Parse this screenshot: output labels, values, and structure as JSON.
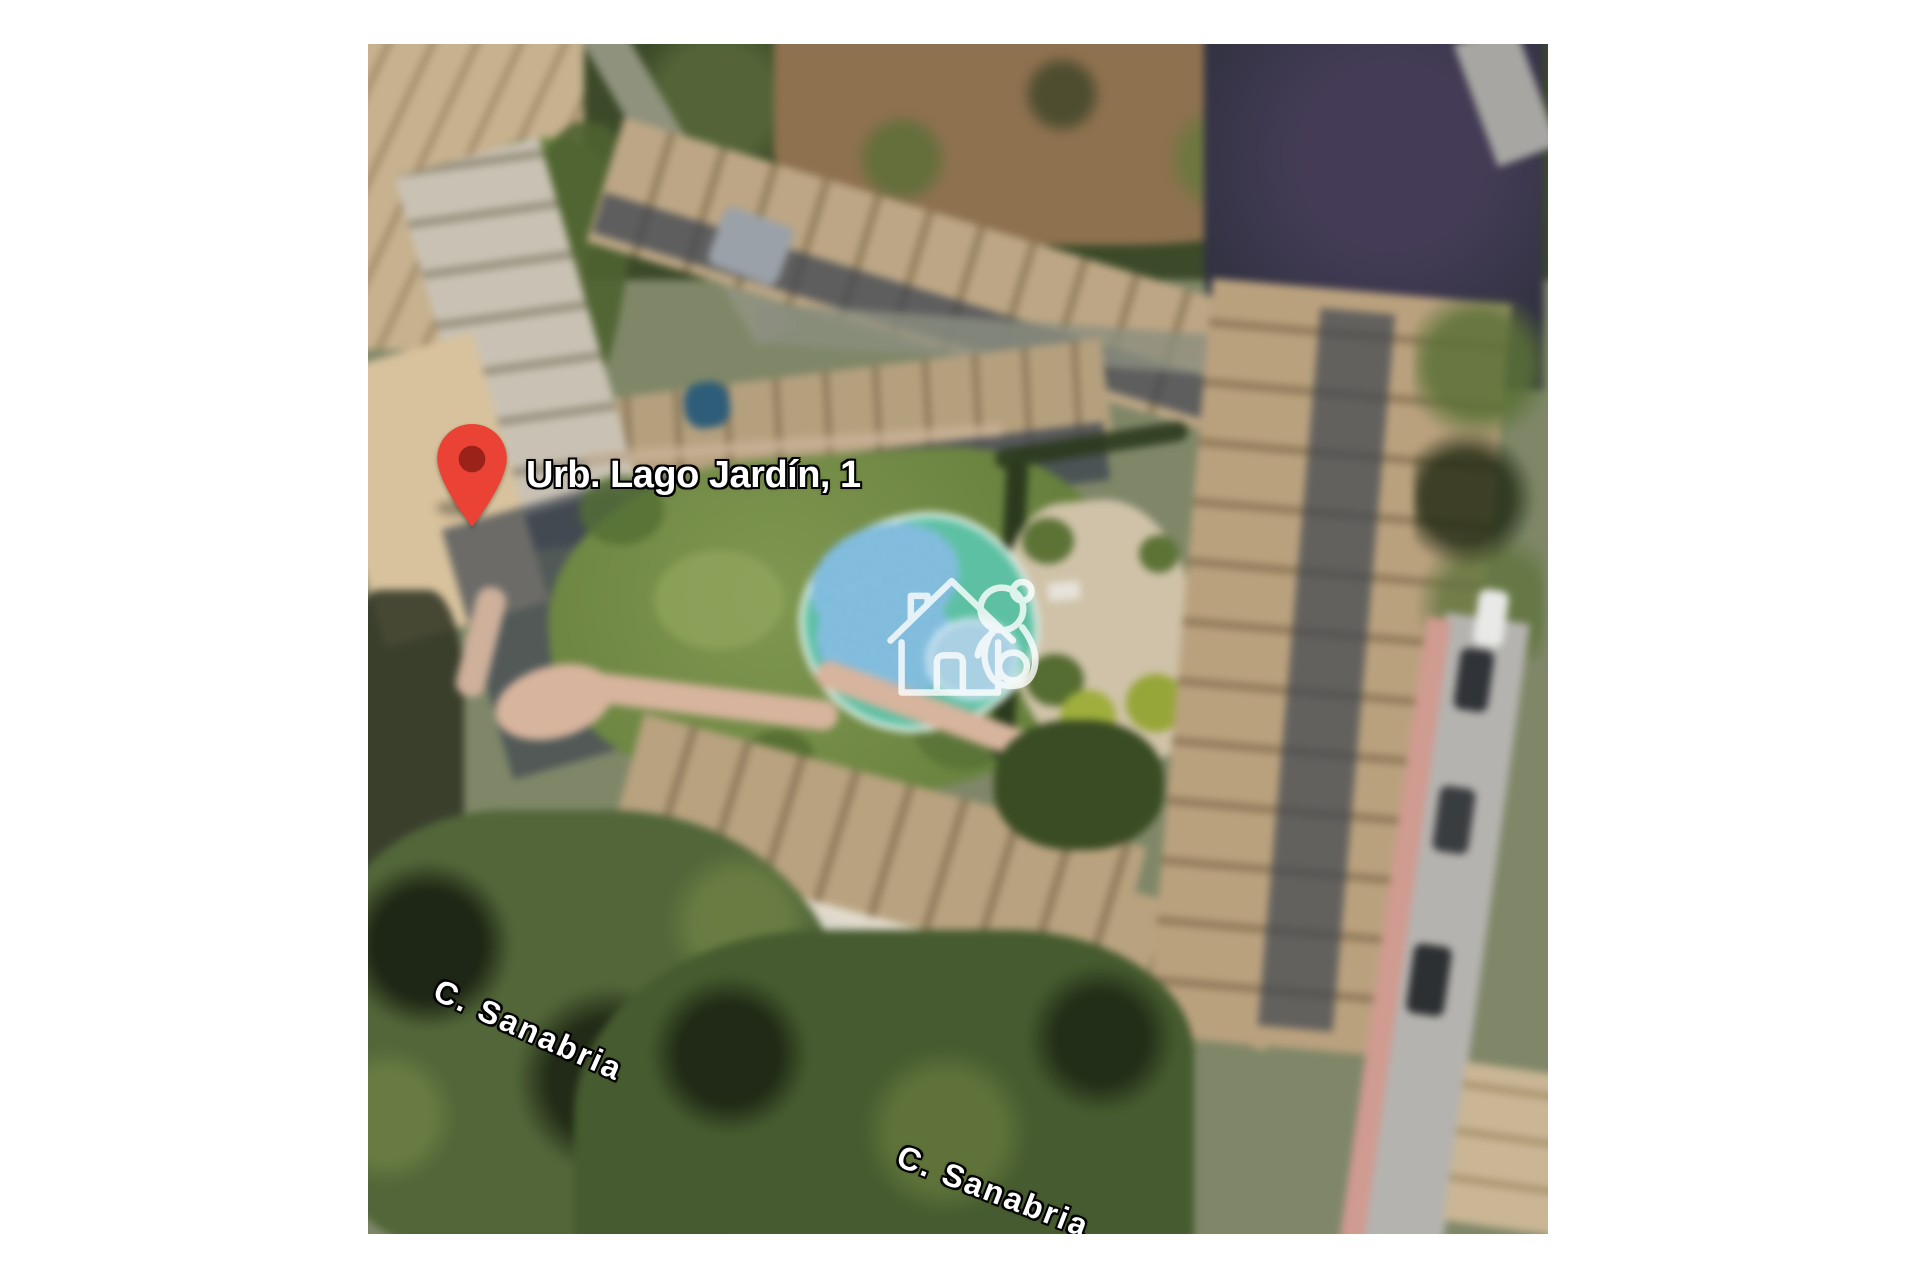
{
  "map": {
    "marker": {
      "label": "Urb. Lago Jardín, 1",
      "pin_color": "#EA4335",
      "pin_dot_color": "#9B2219"
    },
    "street_labels": [
      {
        "text": "C. Sanabria"
      },
      {
        "text": "C. Sanabria"
      }
    ],
    "watermark_color": "#ffffff",
    "watermark_icon": "house-with-koala-watermark",
    "palette": {
      "lawn": "#7f9752",
      "pool": "#7cb9da",
      "pool_small": "#abd0e2",
      "pool_deck": "#5fbfa3",
      "trees_top": "#3c4a2a",
      "trees_dark": "#52663a",
      "trees_purple": "#443c55",
      "dry_field": "#8d7150",
      "roof_tan": "#bca686",
      "roof_dark": "#93805f",
      "roof_gray": "#c9c2b4",
      "building_shadow": "#3f4650",
      "road": "#b5b3af",
      "sidewalk": "#cf9b91",
      "footpath": "#d6b49e",
      "patio": "#cfc2a9",
      "hedge": "#2b3a1e"
    }
  }
}
